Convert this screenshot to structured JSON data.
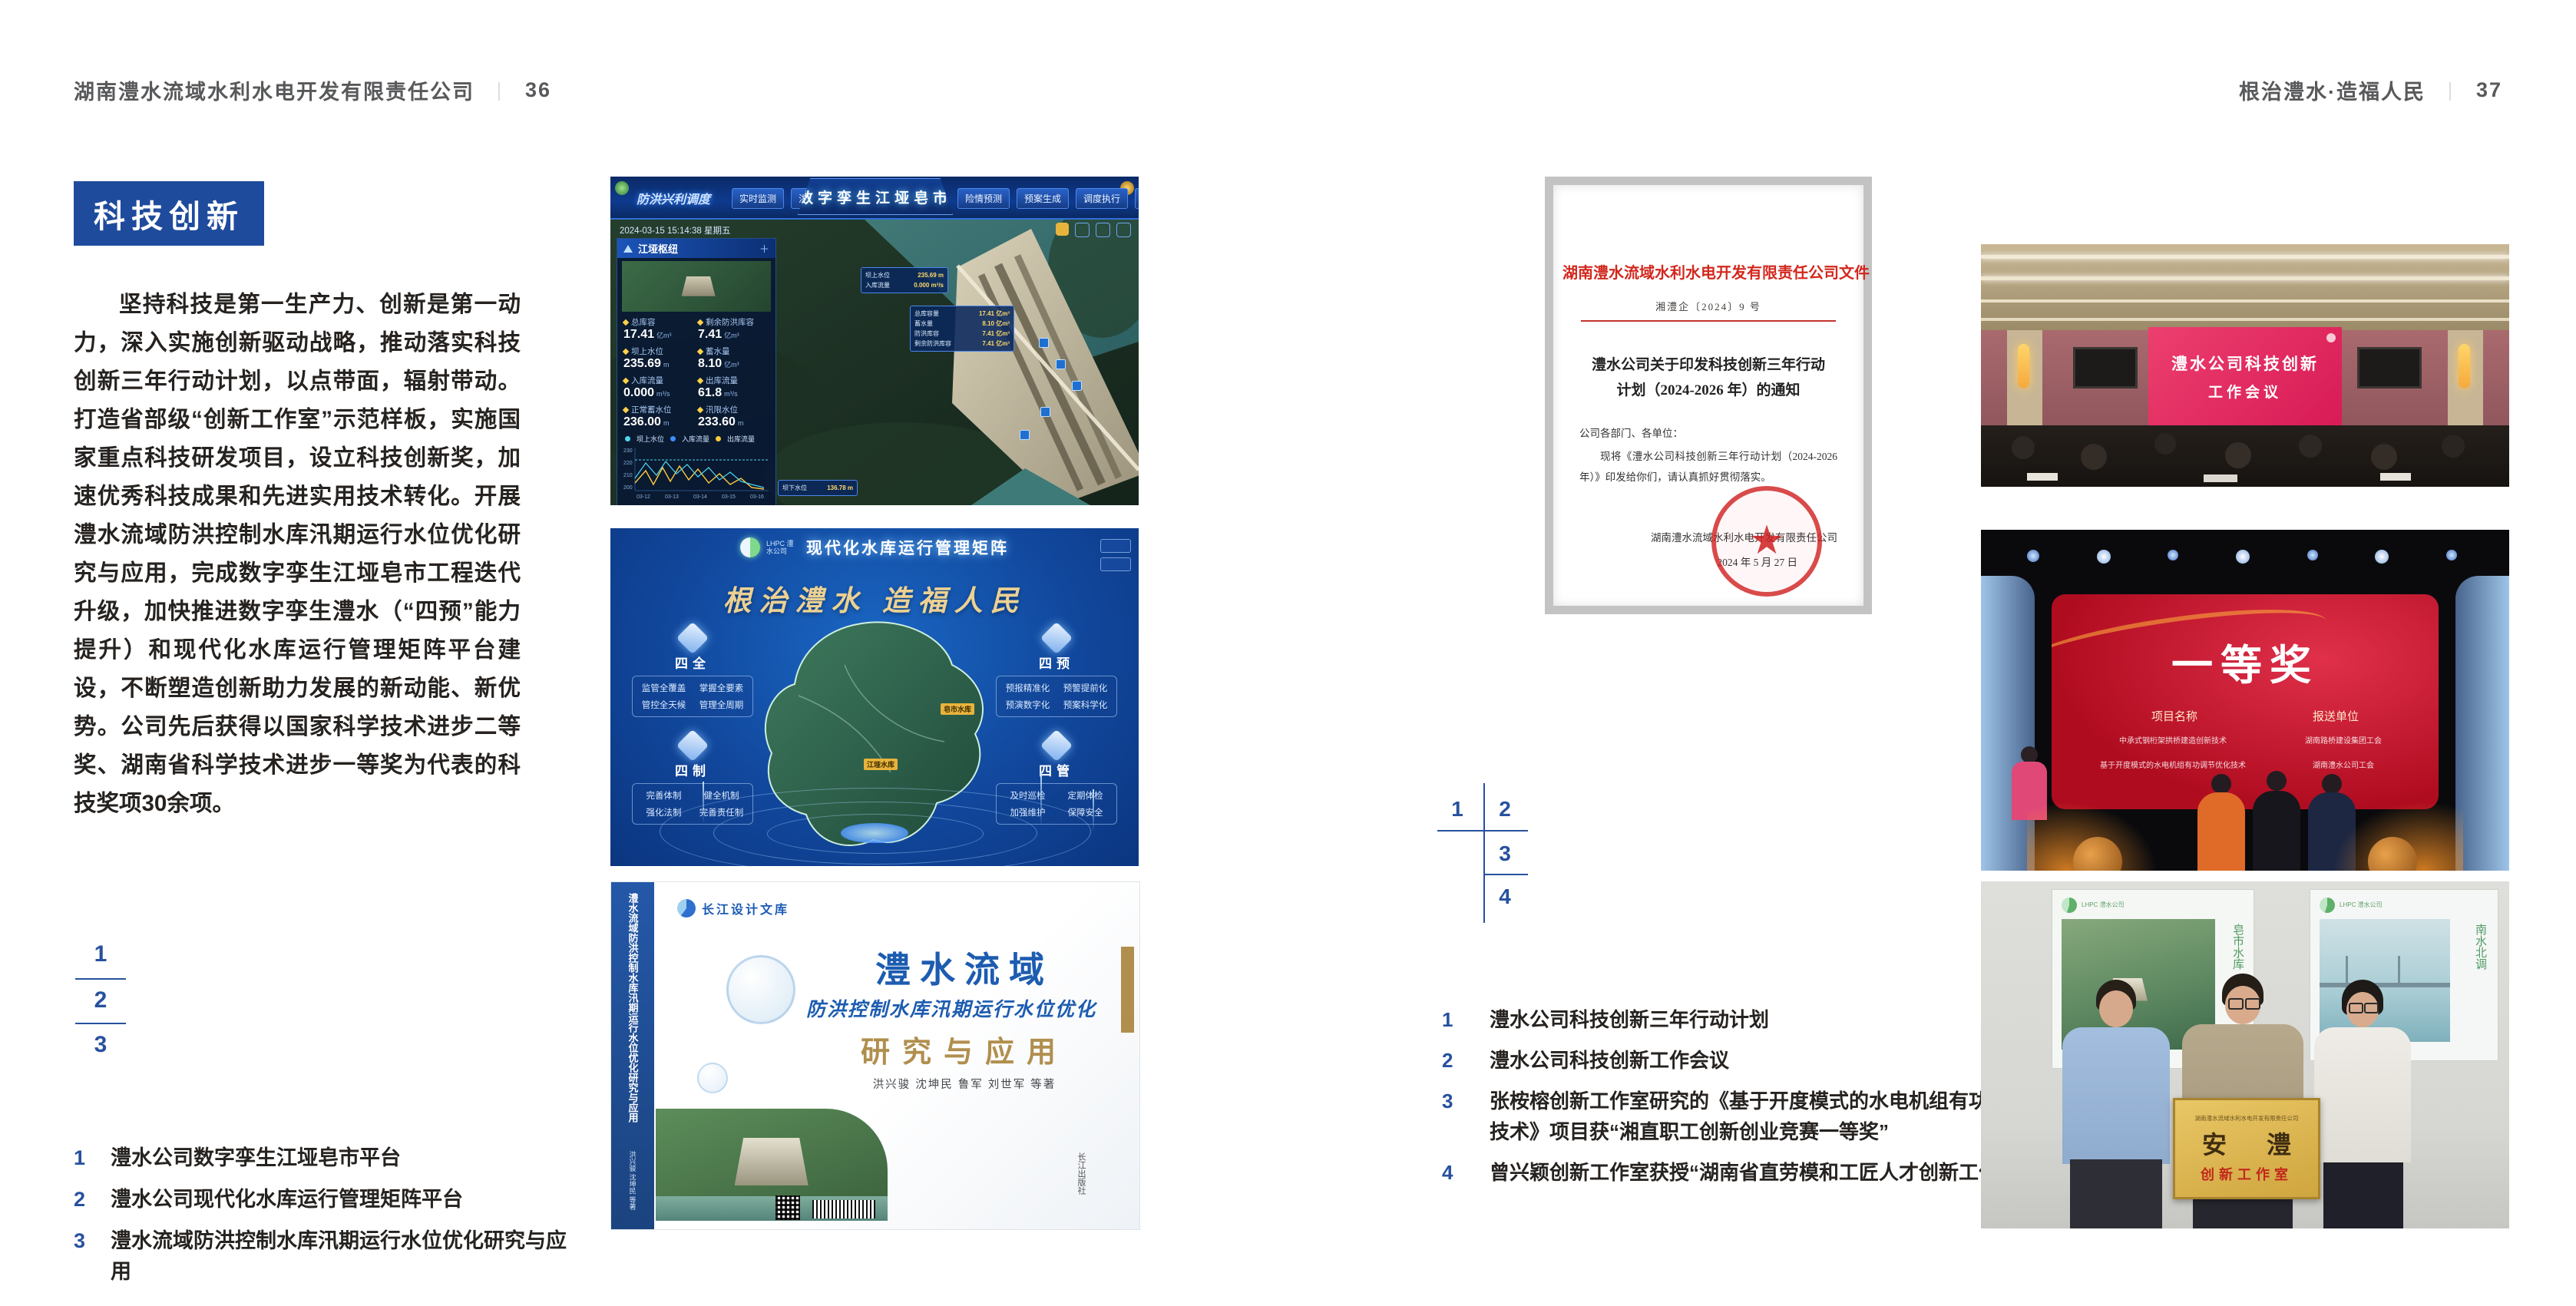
{
  "header": {
    "left": {
      "company": "湖南澧水流域水利水电开发有限责任公司",
      "sep": "｜",
      "page": "36"
    },
    "right": {
      "motto": "根治澧水·造福人民",
      "sep": "｜",
      "page": "37"
    }
  },
  "left_page": {
    "badge": "科技创新",
    "paragraph": "坚持科技是第一生产力、创新是第一动力，深入实施创新驱动战略，推动落实科技创新三年行动计划，以点带面，辐射带动。打造省部级“创新工作室”示范样板，实施国家重点科技研发项目，设立科技创新奖，加速优秀科技成果和先进实用技术转化。开展澧水流域防洪控制水库汛期运行水位优化研究与应用，完成数字孪生江垭皂市工程迭代升级，加快推进数字孪生澧水（“四预”能力提升）和现代化水库运行管理矩阵平台建设，不断塑造创新助力发展的新动能、新优势。公司先后获得以国家科学技术进步二等奖、湖南省科学技术进步一等奖为代表的科技奖项30余项。",
    "keys": [
      "1",
      "2",
      "3"
    ],
    "captions": [
      {
        "num": "1",
        "text": "澧水公司数字孪生江垭皂市平台"
      },
      {
        "num": "2",
        "text": "澧水公司现代化水库运行管理矩阵平台"
      },
      {
        "num": "3",
        "text": "澧水流域防洪控制水库汛期运行水位优化研究与应用"
      }
    ]
  },
  "right_page": {
    "keys": [
      "1",
      "2",
      "3",
      "4"
    ],
    "captions": [
      {
        "num": "1",
        "text": "澧水公司科技创新三年行动计划"
      },
      {
        "num": "2",
        "text": "澧水公司科技创新工作会议"
      },
      {
        "num": "3",
        "text": "张桉榕创新工作室研究的《基于开度模式的水电机组有功调节优化技术》项目获“湘直职工创新创业竞赛一等奖”"
      },
      {
        "num": "4",
        "text": "曾兴颖创新工作室获授“湖南省直劳模和工匠人才创新工作室”"
      }
    ]
  },
  "platform": {
    "title": "数字孪生江垭皂市",
    "subtitle": "防洪兴利调度",
    "nav_left": [
      "实时监测",
      "洪水预报",
      "防洪预警"
    ],
    "nav_right": [
      "险情预测",
      "预案生成",
      "调度执行",
      "工程导览"
    ],
    "timestamp": "2024-03-15 15:14:38 星期五",
    "panel_title": "江垭枢纽",
    "stats": [
      {
        "label": "总库容",
        "value": "17.41",
        "unit": "亿m³"
      },
      {
        "label": "剩余防洪库容",
        "value": "7.41",
        "unit": "亿m³"
      },
      {
        "label": "坝上水位",
        "value": "235.69",
        "unit": "m"
      },
      {
        "label": "蓄水量",
        "value": "8.10",
        "unit": "亿m³"
      },
      {
        "label": "入库流量",
        "value": "0.000",
        "unit": "m³/s"
      },
      {
        "label": "出库流量",
        "value": "61.8",
        "unit": "m³/s"
      },
      {
        "label": "正常蓄水位",
        "value": "236.00",
        "unit": "m"
      },
      {
        "label": "汛限水位",
        "value": "233.60",
        "unit": "m"
      }
    ],
    "legend": [
      "坝上水位",
      "入库流量",
      "出库流量"
    ],
    "chart_x": [
      "03-12",
      "03-13",
      "03-14",
      "03-15",
      "03-16"
    ],
    "section2": "江垭发电",
    "gen_labels": [
      "年发电计划",
      "年累计发电量"
    ],
    "tag1": {
      "rows": [
        {
          "label": "坝上水位",
          "value": "235.69 m"
        },
        {
          "label": "入库流量",
          "value": "0.000 m³/s"
        }
      ]
    },
    "tag2": {
      "rows": [
        {
          "label": "总库容量",
          "value": "17.41 亿m³"
        },
        {
          "label": "蓄水量",
          "value": "8.10 亿m³"
        },
        {
          "label": "防洪库容",
          "value": "7.41 亿m³"
        },
        {
          "label": "剩余防洪库容",
          "value": "7.41 亿m³"
        }
      ]
    },
    "tag3": {
      "label": "坝下水位",
      "value": "136.78 m"
    }
  },
  "matrix": {
    "brand": "LHPC 澧水公司",
    "title": "现代化水库运行管理矩阵",
    "slogan": "根治澧水 造福人民",
    "panels": [
      {
        "name": "四全",
        "items": [
          "监管全覆盖",
          "掌握全要素",
          "管控全天候",
          "管理全周期"
        ]
      },
      {
        "name": "四预",
        "items": [
          "预报精准化",
          "预警提前化",
          "预演数字化",
          "预案科学化"
        ]
      },
      {
        "name": "四制",
        "items": [
          "完善体制",
          "健全机制",
          "强化法制",
          "完善责任制"
        ]
      },
      {
        "name": "四管",
        "items": [
          "及时巡检",
          "定期体检",
          "加强维护",
          "保障安全"
        ]
      }
    ],
    "markers": [
      "皂市水库",
      "江垭水库"
    ]
  },
  "book": {
    "spine_title": "澧水流域防洪控制水库汛期运行水位优化研究与应用",
    "spine_authors": "洪兴骏 沈坤民 等著",
    "brand": "长江设计文库",
    "title1": "澧水流域",
    "title2": "防洪控制水库汛期运行水位优化",
    "title3": "研究与应用",
    "authors": "洪兴骏 沈坤民 鲁军 刘世军 等著",
    "colophon": "长江出版社"
  },
  "document": {
    "letterhead": "湖南澧水流域水利水电开发有限责任公司文件",
    "doc_no": "湘澧企〔2024〕9 号",
    "subject": "澧水公司关于印发科技创新三年行动计划（2024-2026 年）的通知",
    "salutation": "公司各部门、各单位：",
    "body": "现将《澧水公司科技创新三年行动计划（2024-2026 年）》印发给你们，请认真抓好贯彻落实。",
    "signer": "湖南澧水流域水利水电开发有限责任公司",
    "date": "2024 年 5 月 27 日"
  },
  "meeting": {
    "screen_line1": "澧水公司科技创新",
    "screen_line2": "工作会议"
  },
  "award": {
    "title": "一等奖",
    "col1": "项目名称",
    "col2": "报送单位",
    "rows": [
      {
        "project": "中承式钢桁架拱桥建造创新技术",
        "org": "湖南路桥建设集团工会"
      },
      {
        "project": "基于开度模式的水电机组有功调节优化技术",
        "org": "湖南澧水公司工会"
      }
    ]
  },
  "plaque": {
    "header": "湖南澧水流域水利水电开发有限责任公司",
    "calligraphy": "安 澧",
    "label": "创新工作室",
    "poster_left_title": "皂市水库",
    "poster_right_title": "南水北调",
    "poster_brand": "LHPC 澧水公司"
  },
  "colors": {
    "accent_blue": "#1e4b9c",
    "key_blue": "#27519e",
    "doc_red": "#d2281e",
    "screen_red": "#e0215a",
    "gold": "#b08f4e"
  }
}
